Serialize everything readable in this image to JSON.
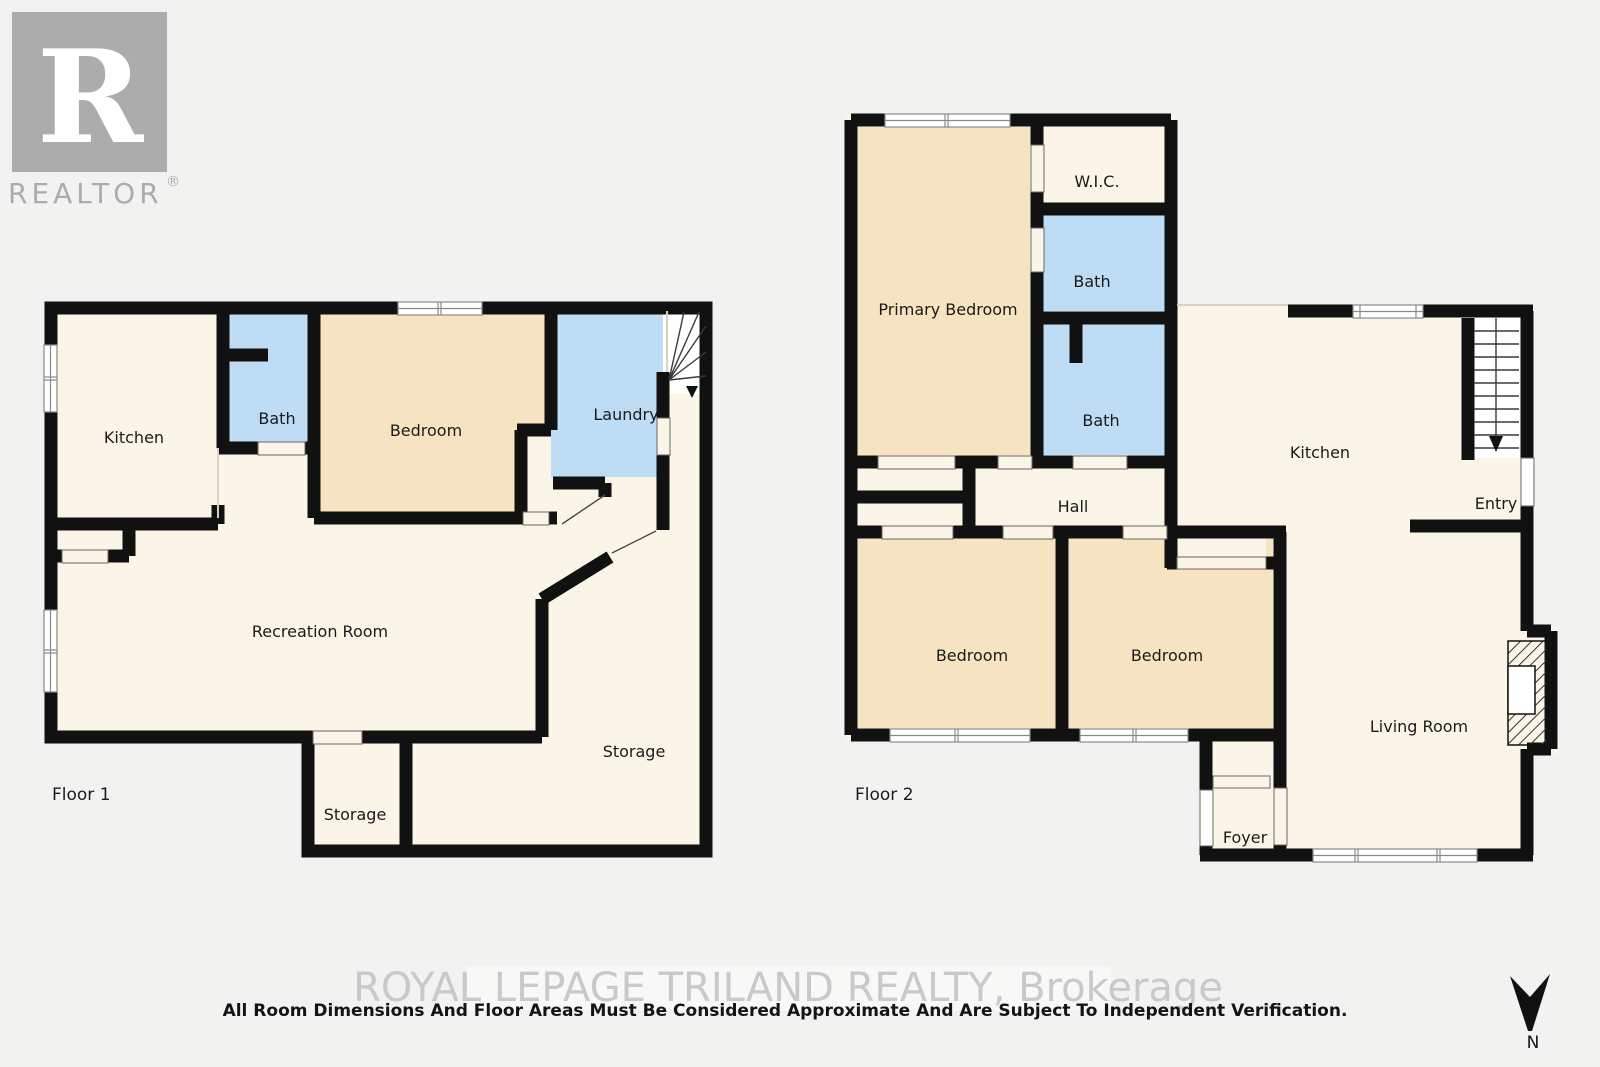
{
  "branding": {
    "logo_letter": "R",
    "logo_word": "REALTOR",
    "registered_mark": "®",
    "watermark": "ROYAL LEPAGE TRILAND REALTY, Brokerage",
    "disclaimer": "All Room Dimensions And Floor Areas Must Be Considered Approximate And Are Subject To Independent Verification."
  },
  "compass": {
    "north_label": "N"
  },
  "floor1": {
    "title": "Floor 1",
    "rooms": {
      "kitchen": "Kitchen",
      "bath": "Bath",
      "bedroom": "Bedroom",
      "laundry": "Laundry",
      "recreation_room": "Recreation Room",
      "storage_small": "Storage",
      "storage_large": "Storage"
    }
  },
  "floor2": {
    "title": "Floor 2",
    "rooms": {
      "primary_bedroom": "Primary Bedroom",
      "wic": "W.I.C.",
      "bath_upper": "Bath",
      "bath_lower": "Bath",
      "hall": "Hall",
      "kitchen": "Kitchen",
      "entry": "Entry",
      "bedroom_left": "Bedroom",
      "bedroom_right": "Bedroom",
      "living_room": "Living Room",
      "foyer": "Foyer"
    }
  },
  "colors": {
    "background": "#f2f2f1",
    "floor": "#faf5e7",
    "bedroom_fill": "#f6e3c2",
    "bath_fill": "#bedcf4",
    "wall": "#111111",
    "label": "#1b1b1b",
    "watermark_text": "#c9c9c9",
    "logo_gray": "#acacac"
  }
}
